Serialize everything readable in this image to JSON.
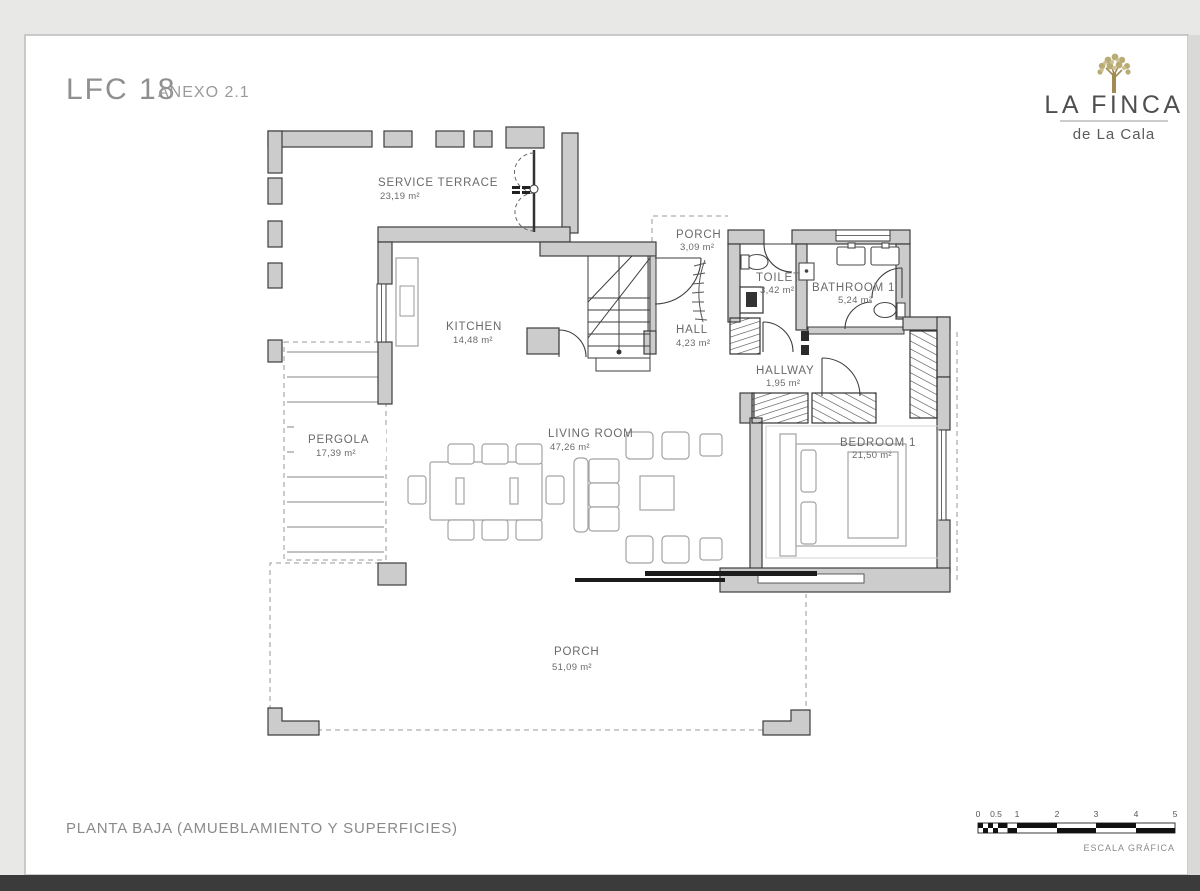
{
  "header": {
    "title": "LFC 18",
    "annex": "ANEXO 2.1"
  },
  "logo": {
    "brand": "LA FINCA",
    "sub": "de La Cala",
    "tree_icon": "olive-tree-icon"
  },
  "rooms": {
    "service_terrace": {
      "name": "SERVICE TERRACE",
      "area": "23,19 m²"
    },
    "porch_top": {
      "name": "PORCH",
      "area": "3,09 m²"
    },
    "toilet": {
      "name": "TOILET",
      "area": "3,42 m²"
    },
    "bathroom": {
      "name": "BATHROOM 1",
      "area": "5,24 m²"
    },
    "kitchen": {
      "name": "KITCHEN",
      "area": "14,48 m²"
    },
    "hall": {
      "name": "HALL",
      "area": "4,23 m²"
    },
    "hallway": {
      "name": "HALLWAY",
      "area": "1,95 m²"
    },
    "pergola": {
      "name": "PERGOLA",
      "area": "17,39 m²"
    },
    "living_room": {
      "name": "LIVING ROOM",
      "area": "47,26 m²"
    },
    "bedroom": {
      "name": "BEDROOM 1",
      "area": "21,50 m²"
    },
    "porch_bottom": {
      "name": "PORCH",
      "area": "51,09 m²"
    }
  },
  "footer": {
    "caption": "PLANTA BAJA (AMUEBLAMIENTO Y SUPERFICIES)"
  },
  "scale": {
    "ticks": [
      "0",
      "0.5",
      "1",
      "2",
      "3",
      "4",
      "5"
    ],
    "label": "ESCALA GRÁFICA"
  },
  "colors": {
    "wall_fill": "#cccccc",
    "wall_stroke": "#3d3d3d",
    "tree": "#b3a36e",
    "page": "#ffffff"
  }
}
